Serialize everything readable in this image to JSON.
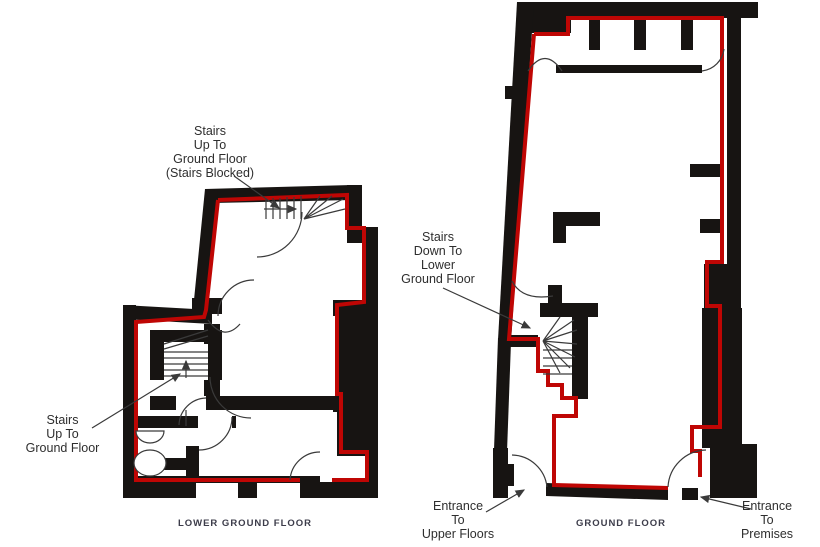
{
  "document": {
    "type": "floor-plan-drawing",
    "background": "#ffffff"
  },
  "colors": {
    "demise_outline_red": "#bf0604",
    "wall_black": "#171412",
    "annotation_text": "#2e2e2e",
    "floor_label_text": "#3c3c4a",
    "detail_line": "#3a3a3a"
  },
  "plans": [
    {
      "id": "lower-ground-floor",
      "label": "LOWER GROUND FLOOR"
    },
    {
      "id": "ground-floor",
      "label": "GROUND FLOOR"
    }
  ],
  "annotations": [
    {
      "id": "stairs-up-blocked",
      "text": "Stairs\nUp To\nGround Floor\n(Stairs Blocked)"
    },
    {
      "id": "stairs-up",
      "text": "Stairs\nUp To\nGround Floor"
    },
    {
      "id": "stairs-down",
      "text": "Stairs\nDown To\nLower\nGround Floor"
    },
    {
      "id": "entrance-upper-floors",
      "text": "Entrance\nTo\nUpper Floors"
    },
    {
      "id": "entrance-premises",
      "text": "Entrance\nTo\nPremises"
    }
  ],
  "symbols": [
    "staircase",
    "door-swing-arc",
    "leader-arrow",
    "stair-direction-arrow",
    "toilet-symbol",
    "basin-symbol"
  ]
}
